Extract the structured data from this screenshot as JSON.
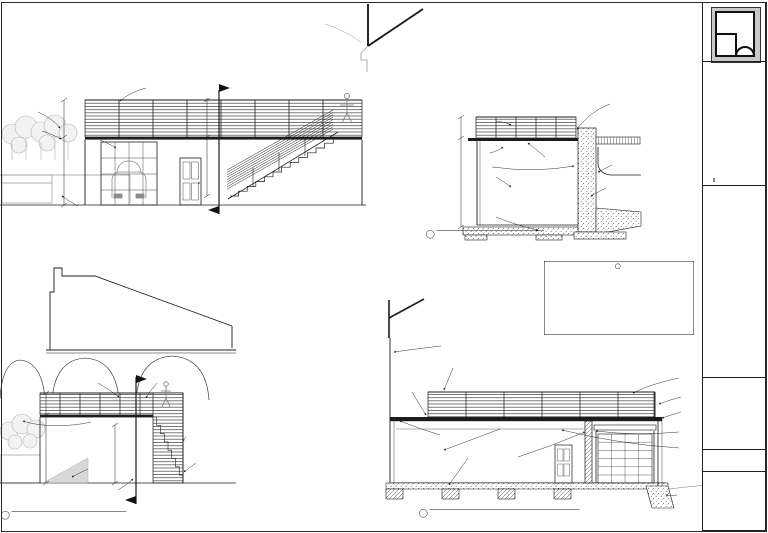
{
  "sheet": {
    "design_caption": "A POOL BATH DESIGN FOR",
    "project_name": "THE PRESCOTT RESIDENCE",
    "project_location": "MALIBU, CA",
    "data_header": "PROJECT DATA:",
    "data_rows": [
      [
        "LOT SIZE",
        "7,500 SF"
      ],
      [
        "EXISTING HOUSE",
        "2,150 SF"
      ],
      [
        "POOL BATH ADDITION",
        "352 SF"
      ],
      [
        "NEW ROOF DECK",
        "368 SF"
      ],
      [
        "LOT COVERAGE",
        "32 %"
      ],
      [
        "TOTAL NEW CONST.",
        "720 SF"
      ]
    ],
    "contents_header": "SHEET CONTENTS:",
    "contents": [
      "EXTERIOR ELEVATIONS",
      "BUILDING SECTIONS",
      "DOOR & WINDOW SCHEDULE"
    ],
    "fields": [
      [
        "DRAWN:",
        "MP"
      ],
      [
        "DATE:",
        "10-04"
      ],
      [
        "SCALE:",
        "AS NOTED"
      ]
    ],
    "sheet_number": "A2",
    "sheet_of": "2 OF 3"
  },
  "drawing_titles": {
    "elev": {
      "num": "1",
      "name": "EXTERIOR ELEVATIONS",
      "scale": "SCALE: 1/4\"=1'-0\""
    },
    "aa": {
      "num": "2",
      "name": "BUILDING SECTION A-A",
      "scale": "SCALE: 1/4\"=1'-0\""
    },
    "bb": {
      "num": "3",
      "name": "BUILDING SECTION B-B",
      "scale": "SCALE: 1/4\"=1'-0\""
    }
  },
  "door_schedule": {
    "title": "DOOR SCHEDULE",
    "columns": [
      "SYM.",
      "SIZE",
      "THK.",
      "DESCRIPTION"
    ],
    "rows": [
      [
        "1",
        "7'-0\" x 8'-0\"",
        "—",
        "EXT. OVERHEAD GARAGE DOOR"
      ],
      [
        "2",
        "3'-0\" x 7'-0\"",
        "1¾\"",
        "EXT. ENTRY DOOR WITH METAL THRESHOLD"
      ],
      [
        "3",
        "2'-6\" x 7'-0\"",
        "1⅜\"",
        "INT. CLOSET DOOR SLAB, WITH JAM AND CASING"
      ]
    ],
    "notes": [
      "1.  ALL EGRESS DOORS SHALL BE READILY OPENABLE FROM THE SIDE WHICH EGRESS IS TO BE MADE WITHOUT THE USE OF A KEY.",
      "2.  AT LEAST ONE EGRESS DOOR SHALL BE A SIDE-HINGED DOOR NOT LESS THAN 3' WIDE AND 6'-8\" HIGH."
    ]
  },
  "annotations": [
    {
      "t": "Metal Guard Rail\nBuilt per code",
      "x": 131,
      "y": 80
    },
    {
      "t": "EXISTING\nWOOD\nFENCE",
      "x": 24,
      "y": 103
    },
    {
      "t": "FLOOR\nJOISTS",
      "x": 28,
      "y": 126
    },
    {
      "t": "STUCCO\nTYP.",
      "x": 90,
      "y": 133
    },
    {
      "t": "FL. HT.",
      "x": 44,
      "y": 138
    },
    {
      "t": "FIN. FLR.",
      "x": 42,
      "y": 196
    },
    {
      "t": "PLANTER\nBY OTHERS",
      "x": 64,
      "y": 204
    },
    {
      "t": "8'H x 7'W, Glass & Steel\nAutomatic Garage Door",
      "x": 104,
      "y": 201
    },
    {
      "t": "LEFT ELEVATION",
      "x": 48,
      "y": 212,
      "b": 1,
      "fs": 7.5
    },
    {
      "t": "FIN. FLR.",
      "x": 248,
      "y": 194
    },
    {
      "t": "HOUSE",
      "x": 308,
      "y": 20,
      "c": "#8a8a8a"
    },
    {
      "t": "3'-6\"",
      "x": 199,
      "y": 130,
      "r": -90
    },
    {
      "t": "10'-0\"",
      "x": 199,
      "y": 185,
      "r": -90
    },
    {
      "t": "GUARD RAIL",
      "x": 472,
      "y": 118
    },
    {
      "t": "FL. HT.",
      "x": 462,
      "y": 139
    },
    {
      "t": "STUCCO ON\nMETAL LATH",
      "x": 464,
      "y": 148
    },
    {
      "t": "Concrete Retaining\nWall By Engineer",
      "x": 458,
      "y": 161
    },
    {
      "t": "Gravel\nBase",
      "x": 488,
      "y": 172
    },
    {
      "t": "Backfill With\nCompacted Soil",
      "x": 530,
      "y": 158
    },
    {
      "t": "POOL",
      "x": 592,
      "y": 152,
      "c": "#999999",
      "fs": 9
    },
    {
      "t": "TREX DECK WITH\nCONCRETE COPING\nAND ARTIFICIAL\nTURF LAWN",
      "x": 598,
      "y": 94
    },
    {
      "t": "EXISTING POOL SHELL\n(ALREADY IN PLACE)",
      "x": 614,
      "y": 160
    },
    {
      "t": "NEW CONCRETE\nWALL FOOTING\nAND SLAB",
      "x": 608,
      "y": 182
    },
    {
      "t": "CONCRETE\nFOOTINGS\nPER ENGINEER",
      "x": 477,
      "y": 210
    },
    {
      "t": "FIN. FLR.",
      "x": 462,
      "y": 222
    },
    {
      "t": "3'-6\"",
      "x": 455,
      "y": 132,
      "r": -90
    },
    {
      "t": "10'-0\"",
      "x": 455,
      "y": 190,
      "r": -90
    },
    {
      "t": "GUARD RAIL\nBUILT TO CODE",
      "x": 72,
      "y": 376
    },
    {
      "t": "GUARD RAIL",
      "x": 158,
      "y": 375
    },
    {
      "t": "STONE COPING",
      "x": 93,
      "y": 419
    },
    {
      "t": "PLASTER\nBY OTHERS",
      "x": 90,
      "y": 464
    },
    {
      "t": "RAIL SYSTEM TO\nMEET LOCAL\nCODE",
      "x": 188,
      "y": 431
    },
    {
      "t": "CONCRETE\nSTEPS BY\nENGINEER",
      "x": 198,
      "y": 458
    },
    {
      "t": "STUCCO\nWALL",
      "x": 111,
      "y": 490
    },
    {
      "t": "FL. HT.",
      "x": 16,
      "y": 418
    },
    {
      "t": "FL. HT.",
      "x": 133,
      "y": 418
    },
    {
      "t": "FIN. FLR.",
      "x": 16,
      "y": 476
    },
    {
      "t": "FIN. FLR.",
      "x": 116,
      "y": 476
    },
    {
      "t": "REAR ELEVATION",
      "x": 41,
      "y": 496,
      "b": 1,
      "fs": 7.5
    },
    {
      "t": "3'-6\"",
      "x": 42,
      "y": 408,
      "r": -90
    },
    {
      "t": "10'-0\"",
      "x": 111,
      "y": 458,
      "r": -90
    },
    {
      "t": "EXISTING HOUSE",
      "x": 443,
      "y": 343
    },
    {
      "t": "GUARD RAIL\nBUILT TO CODE",
      "x": 441,
      "y": 358
    },
    {
      "t": "METAL\nDECK",
      "x": 403,
      "y": 384
    },
    {
      "t": "CONCRETE PLATFORM BEAM",
      "x": 414,
      "y": 436
    },
    {
      "t": "BACKFILL\nCOMPACTED SOIL",
      "x": 502,
      "y": 424
    },
    {
      "t": "INTERMEDIATE FOOTINGS\nPER ENGINEER",
      "x": 452,
      "y": 450
    },
    {
      "t": "CONCRETE RETAINING\nWALL BY ENGINEER",
      "x": 488,
      "y": 453
    },
    {
      "t": "TREX DECK WITH\nCONCRETE COPING\nAND ARTIFICIAL\nTURF LAWN",
      "x": 681,
      "y": 370
    },
    {
      "t": "GUARD RAIL",
      "x": 683,
      "y": 395
    },
    {
      "t": "STEEL BEAM",
      "x": 683,
      "y": 410
    },
    {
      "t": "FL. HT.",
      "x": 664,
      "y": 419
    },
    {
      "t": "W8 STEEL\nCOLUMNS BY\nENGINEER",
      "x": 681,
      "y": 426
    },
    {
      "t": "GYPSUM BOARD\nCEILING",
      "x": 681,
      "y": 444
    },
    {
      "t": "FIN. FLR.",
      "x": 690,
      "y": 475
    },
    {
      "t": "CONCRETE\nFOOTING\nPER ENGINEER",
      "x": 679,
      "y": 490
    },
    {
      "t": "3'-6\"",
      "x": 708,
      "y": 408,
      "r": -90
    },
    {
      "t": "10'-0\"",
      "x": 708,
      "y": 456,
      "r": -90
    }
  ]
}
